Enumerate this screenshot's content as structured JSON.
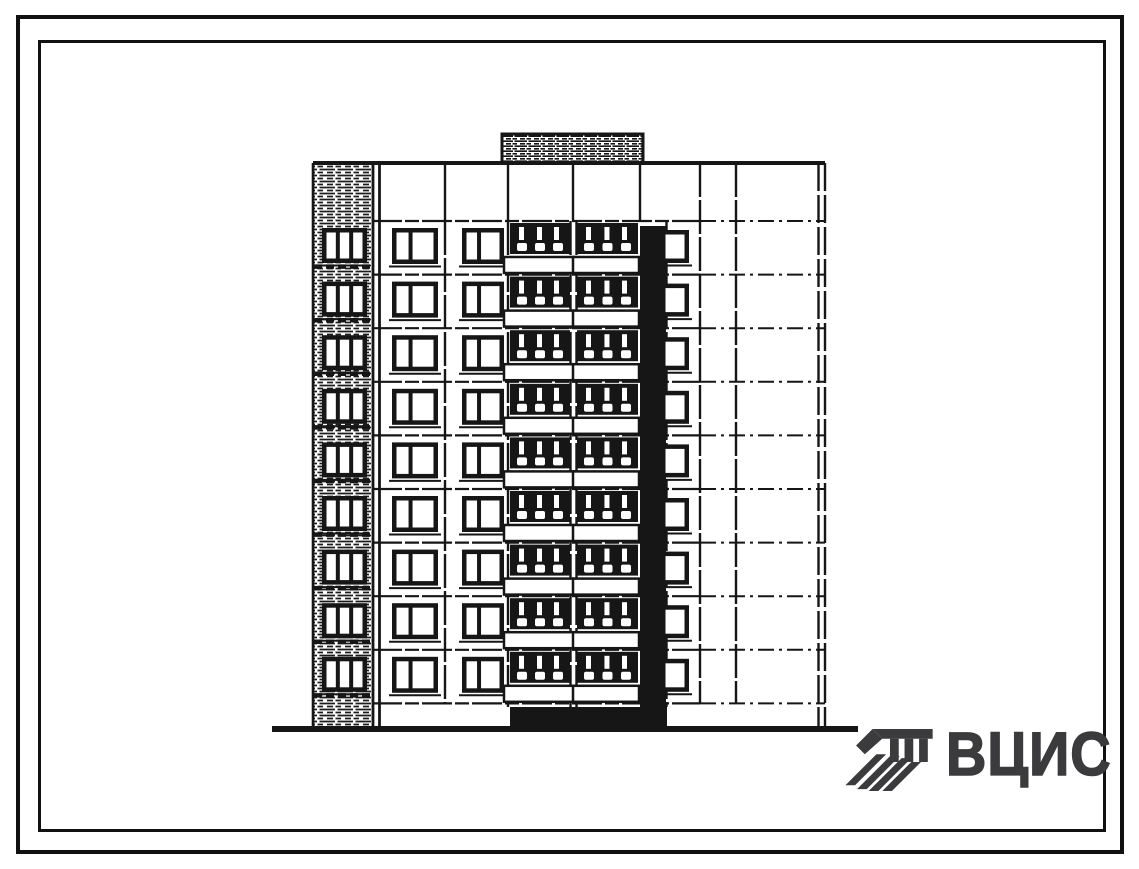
{
  "colors": {
    "ink": "#161616",
    "paper": "#ffffff",
    "logo": "#3b3b3d"
  },
  "frame": {
    "outer": {
      "x": 16,
      "y": 15,
      "w": 1108,
      "h": 839,
      "stroke": 4
    },
    "inner": {
      "x": 38,
      "y": 40,
      "w": 1068,
      "h": 792,
      "stroke": 3
    }
  },
  "logo": {
    "text": "ВЦИС",
    "icon": "hatched-panel-mark-icon"
  },
  "elevation": {
    "type": "building-elevation",
    "floors": 9,
    "floor_h": 53.6,
    "roof_y": 163,
    "attic_bottom_y": 221,
    "ground_y": 729,
    "window_dy": 7,
    "building": {
      "left": 313,
      "right": 825
    },
    "ground_line": {
      "x1": 272,
      "x2": 858,
      "w": 6
    },
    "machine_room": {
      "x": 502,
      "y": 134,
      "w": 141,
      "h": 29
    },
    "end_strip": {
      "x": 313,
      "w": 59,
      "win_dx": 9,
      "win_w": 45,
      "win_h": 35,
      "panes": 3
    },
    "left_edge_x": [
      373,
      379.5
    ],
    "right_edge_x": [
      818.5,
      825
    ],
    "attic_dividers_x": [
      445,
      508,
      573,
      640
    ],
    "verticals": [
      {
        "x": 445,
        "y1": 221,
        "y2": 703
      },
      {
        "x": 508,
        "y1": 221,
        "y2": 707
      },
      {
        "x": 570.5,
        "y1": 221,
        "y2": 707
      },
      {
        "x": 576.5,
        "y1": 221,
        "y2": 707
      },
      {
        "x": 666.5,
        "y1": 221,
        "y2": 707
      },
      {
        "x": 700,
        "y1": 163,
        "y2": 703
      },
      {
        "x": 736,
        "y1": 163,
        "y2": 703
      }
    ],
    "window_cols": [
      {
        "x": 392,
        "w": 46,
        "h": 36,
        "panes": 2,
        "dy": 0
      },
      {
        "x": 462,
        "w": 42,
        "h": 36,
        "panes": 2,
        "dy": 0
      },
      {
        "x": 661,
        "w": 28,
        "h": 33,
        "panes": 1,
        "dy": 2
      }
    ],
    "balconies": [
      {
        "bx": 510,
        "bw": 60,
        "px": 504,
        "pw": 70
      },
      {
        "bx": 577,
        "bw": 61,
        "px": 573,
        "pw": 66
      }
    ],
    "shaft": {
      "x": 640,
      "w": 26,
      "y1": 226,
      "y2": 729
    },
    "plinth_black": {
      "x": 510,
      "y": 707,
      "w": 157,
      "h": 20
    }
  }
}
